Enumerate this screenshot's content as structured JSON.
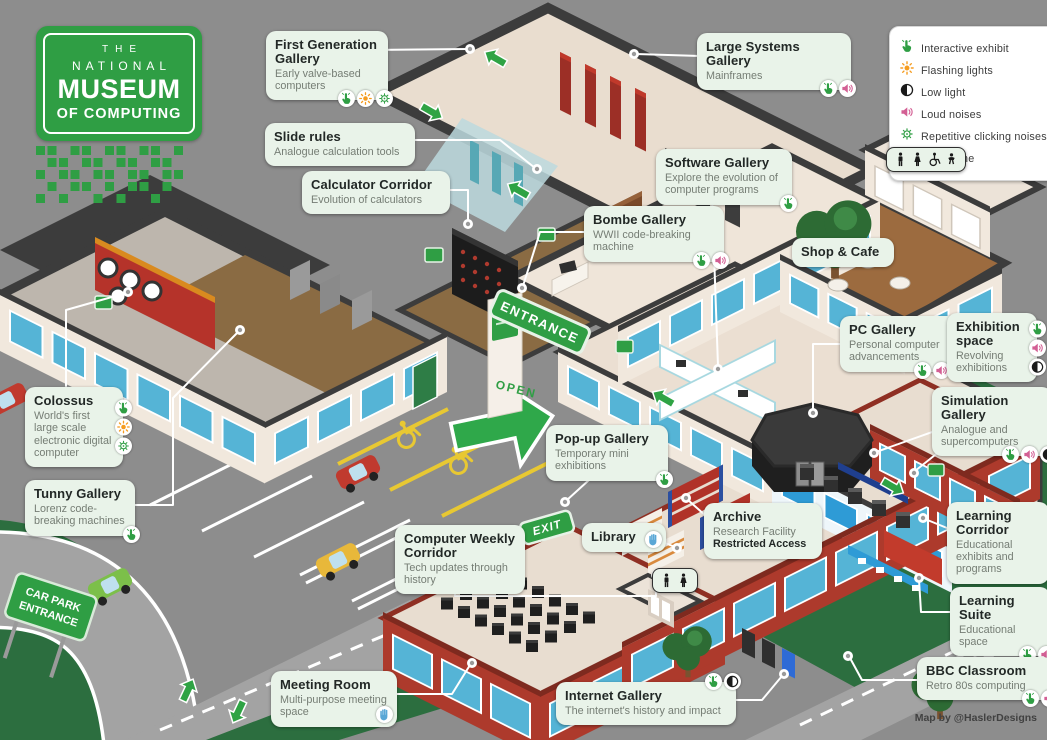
{
  "logo": {
    "line1": "THE",
    "line2": "NATIONAL",
    "line3": "MUSEUM",
    "line4": "OF COMPUTING"
  },
  "legend": [
    {
      "icons": [
        "interactive"
      ],
      "label": "Interactive exhibit"
    },
    {
      "icons": [
        "flashing"
      ],
      "label": "Flashing lights"
    },
    {
      "icons": [
        "lowlight"
      ],
      "label": "Low light"
    },
    {
      "icons": [
        "loud"
      ],
      "label": "Loud noises"
    },
    {
      "icons": [
        "clicking"
      ],
      "label": "Repetitive clicking noises"
    },
    {
      "icons": [
        "calm"
      ],
      "label": "Calm zone"
    }
  ],
  "signs": {
    "entrance": "ENTRANCE",
    "exit": "EXIT",
    "open": "OPEN",
    "car_park_line1": "CAR PARK",
    "car_park_line2": "ENTRANCE"
  },
  "credit": "Map by @HaslerDesigns",
  "callouts": {
    "first_generation_gallery": {
      "title": "First Generation Gallery",
      "subtitle": "Early valve-based computers",
      "icons": [
        "interactive",
        "flashing",
        "clicking"
      ]
    },
    "large_systems_gallery": {
      "title": "Large Systems Gallery",
      "subtitle": "Mainframes",
      "icons": [
        "interactive",
        "loud"
      ]
    },
    "slide_rules": {
      "title": "Slide rules",
      "subtitle": "Analogue calculation tools",
      "icons": []
    },
    "calculator_corridor": {
      "title": "Calculator Corridor",
      "subtitle": "Evolution of calculators",
      "icons": []
    },
    "software_gallery": {
      "title": "Software Gallery",
      "subtitle": "Explore the evolution of computer programs",
      "icons": [
        "interactive"
      ]
    },
    "bombe_gallery": {
      "title": "Bombe Gallery",
      "subtitle": "WWII code-breaking machine",
      "icons": [
        "interactive",
        "loud"
      ]
    },
    "shop_cafe": {
      "title": "Shop & Cafe",
      "subtitle": "",
      "icons": []
    },
    "pc_gallery": {
      "title": "PC Gallery",
      "subtitle": "Personal computer advancements",
      "icons": [
        "interactive",
        "loud",
        "lowlight"
      ]
    },
    "exhibition_space": {
      "title": "Exhibition space",
      "subtitle": "Revolving exhibitions",
      "icons": [
        "interactive",
        "loud",
        "lowlight"
      ]
    },
    "simulation_gallery": {
      "title": "Simulation Gallery",
      "subtitle": "Analogue and supercomputers",
      "icons": [
        "interactive",
        "loud",
        "lowlight"
      ]
    },
    "colossus": {
      "title": "Colossus",
      "subtitle": "World's first large scale electronic digital computer",
      "icons": [
        "interactive",
        "flashing",
        "clicking"
      ]
    },
    "tunny_gallery": {
      "title": "Tunny Gallery",
      "subtitle": "Lorenz code-breaking machines",
      "icons": [
        "interactive"
      ]
    },
    "pop_up_gallery": {
      "title": "Pop-up Gallery",
      "subtitle": "Temporary mini exhibitions",
      "icons": [
        "interactive"
      ]
    },
    "library": {
      "title": "Library",
      "subtitle": "",
      "icons": [
        "calm"
      ]
    },
    "archive": {
      "title": "Archive",
      "subtitle": "Research Facility",
      "note": "Restricted Access",
      "icons": []
    },
    "computer_weekly_corridor": {
      "title": "Computer Weekly Corridor",
      "subtitle": "Tech updates through history",
      "icons": []
    },
    "learning_corridor": {
      "title": "Learning Corridor",
      "subtitle": "Educational exhibits and programs",
      "icons": []
    },
    "learning_suite": {
      "title": "Learning Suite",
      "subtitle": "Educational space",
      "icons": [
        "interactive",
        "loud"
      ]
    },
    "bbc_classroom": {
      "title": "BBC Classroom",
      "subtitle": "Retro 80s computing",
      "icons": [
        "interactive",
        "loud"
      ]
    },
    "meeting_room": {
      "title": "Meeting Room",
      "subtitle": "Multi-purpose meeting space",
      "icons": [
        "calm"
      ]
    },
    "internet_gallery": {
      "title": "Internet Gallery",
      "subtitle": "The internet's history and impact",
      "icons": [
        "interactive",
        "lowlight"
      ]
    },
    "toilets_main": {
      "icons": [
        "man",
        "woman",
        "wheelchair",
        "baby"
      ]
    },
    "toilets_lower": {
      "icons": [
        "man",
        "woman"
      ]
    }
  }
}
